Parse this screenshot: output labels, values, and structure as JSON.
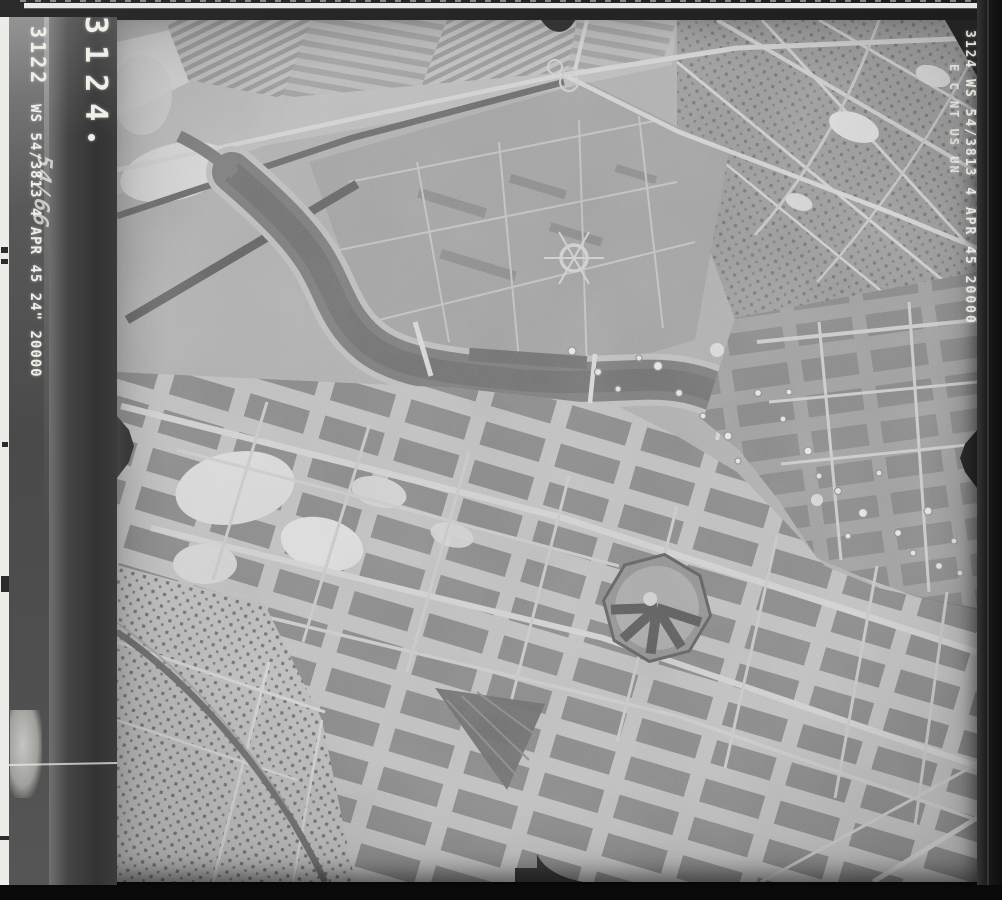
{
  "scan": {
    "film_edge": {
      "frame_number": "3122",
      "annotation": "WS 54/3813 4 APR 45 24\" 20000",
      "handwriting": "54/66"
    },
    "rebate": {
      "frame_number": "3124"
    },
    "right_edge": {
      "annotation_line1": "3124 WS 54/3813 4 APR 45 20000",
      "annotation_line2": "E C NT US UN"
    },
    "photo": {
      "description": "Vertical aerial reconnaissance photograph: bomb-damaged city with meandering river, fields and autobahn interchange at top, radial prison/fort complex, dense diagonal street grid",
      "fiducials": [
        "left-edge-notch",
        "right-edge-notch",
        "top-edge-notch",
        "bottom-edge-notch"
      ]
    },
    "colors": {
      "annotation_text": "#f0efe8",
      "film_border": "#1e1e1e",
      "photo_base": "#b3b3b3"
    }
  }
}
